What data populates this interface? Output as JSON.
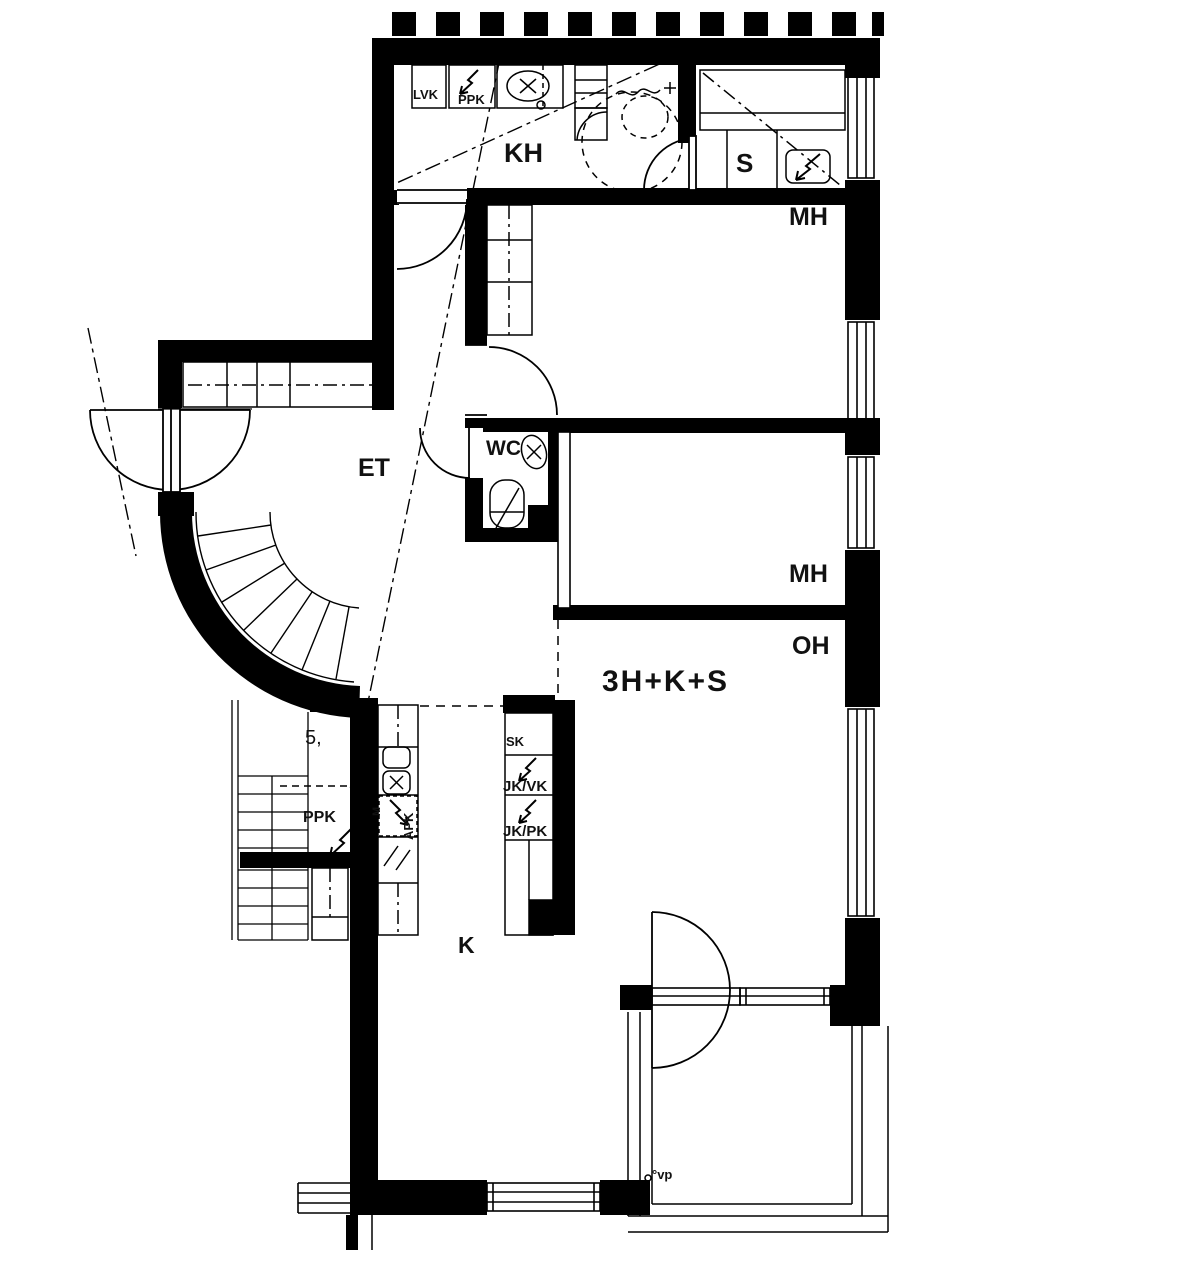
{
  "plan": {
    "apartment_type": "3H+K+S",
    "colors": {
      "line": "#000000",
      "background": "#ffffff"
    },
    "rooms": {
      "kh": "KH",
      "sauna": "S",
      "mh_top": "MH",
      "mh_middle": "MH",
      "oh": "OH",
      "et": "ET",
      "wc": "WC",
      "kitchen": "K"
    },
    "fixtures": {
      "lvk": "LVK",
      "ppk_bathroom": "PPK",
      "ppk_utility": "PPK",
      "m": "M",
      "apk": "APK",
      "sk": "SK",
      "jk_vk": "JK/VK",
      "jk_pk": "JK/PK"
    },
    "annotations": {
      "stair_mark": "5,",
      "vp": "°vp"
    }
  }
}
